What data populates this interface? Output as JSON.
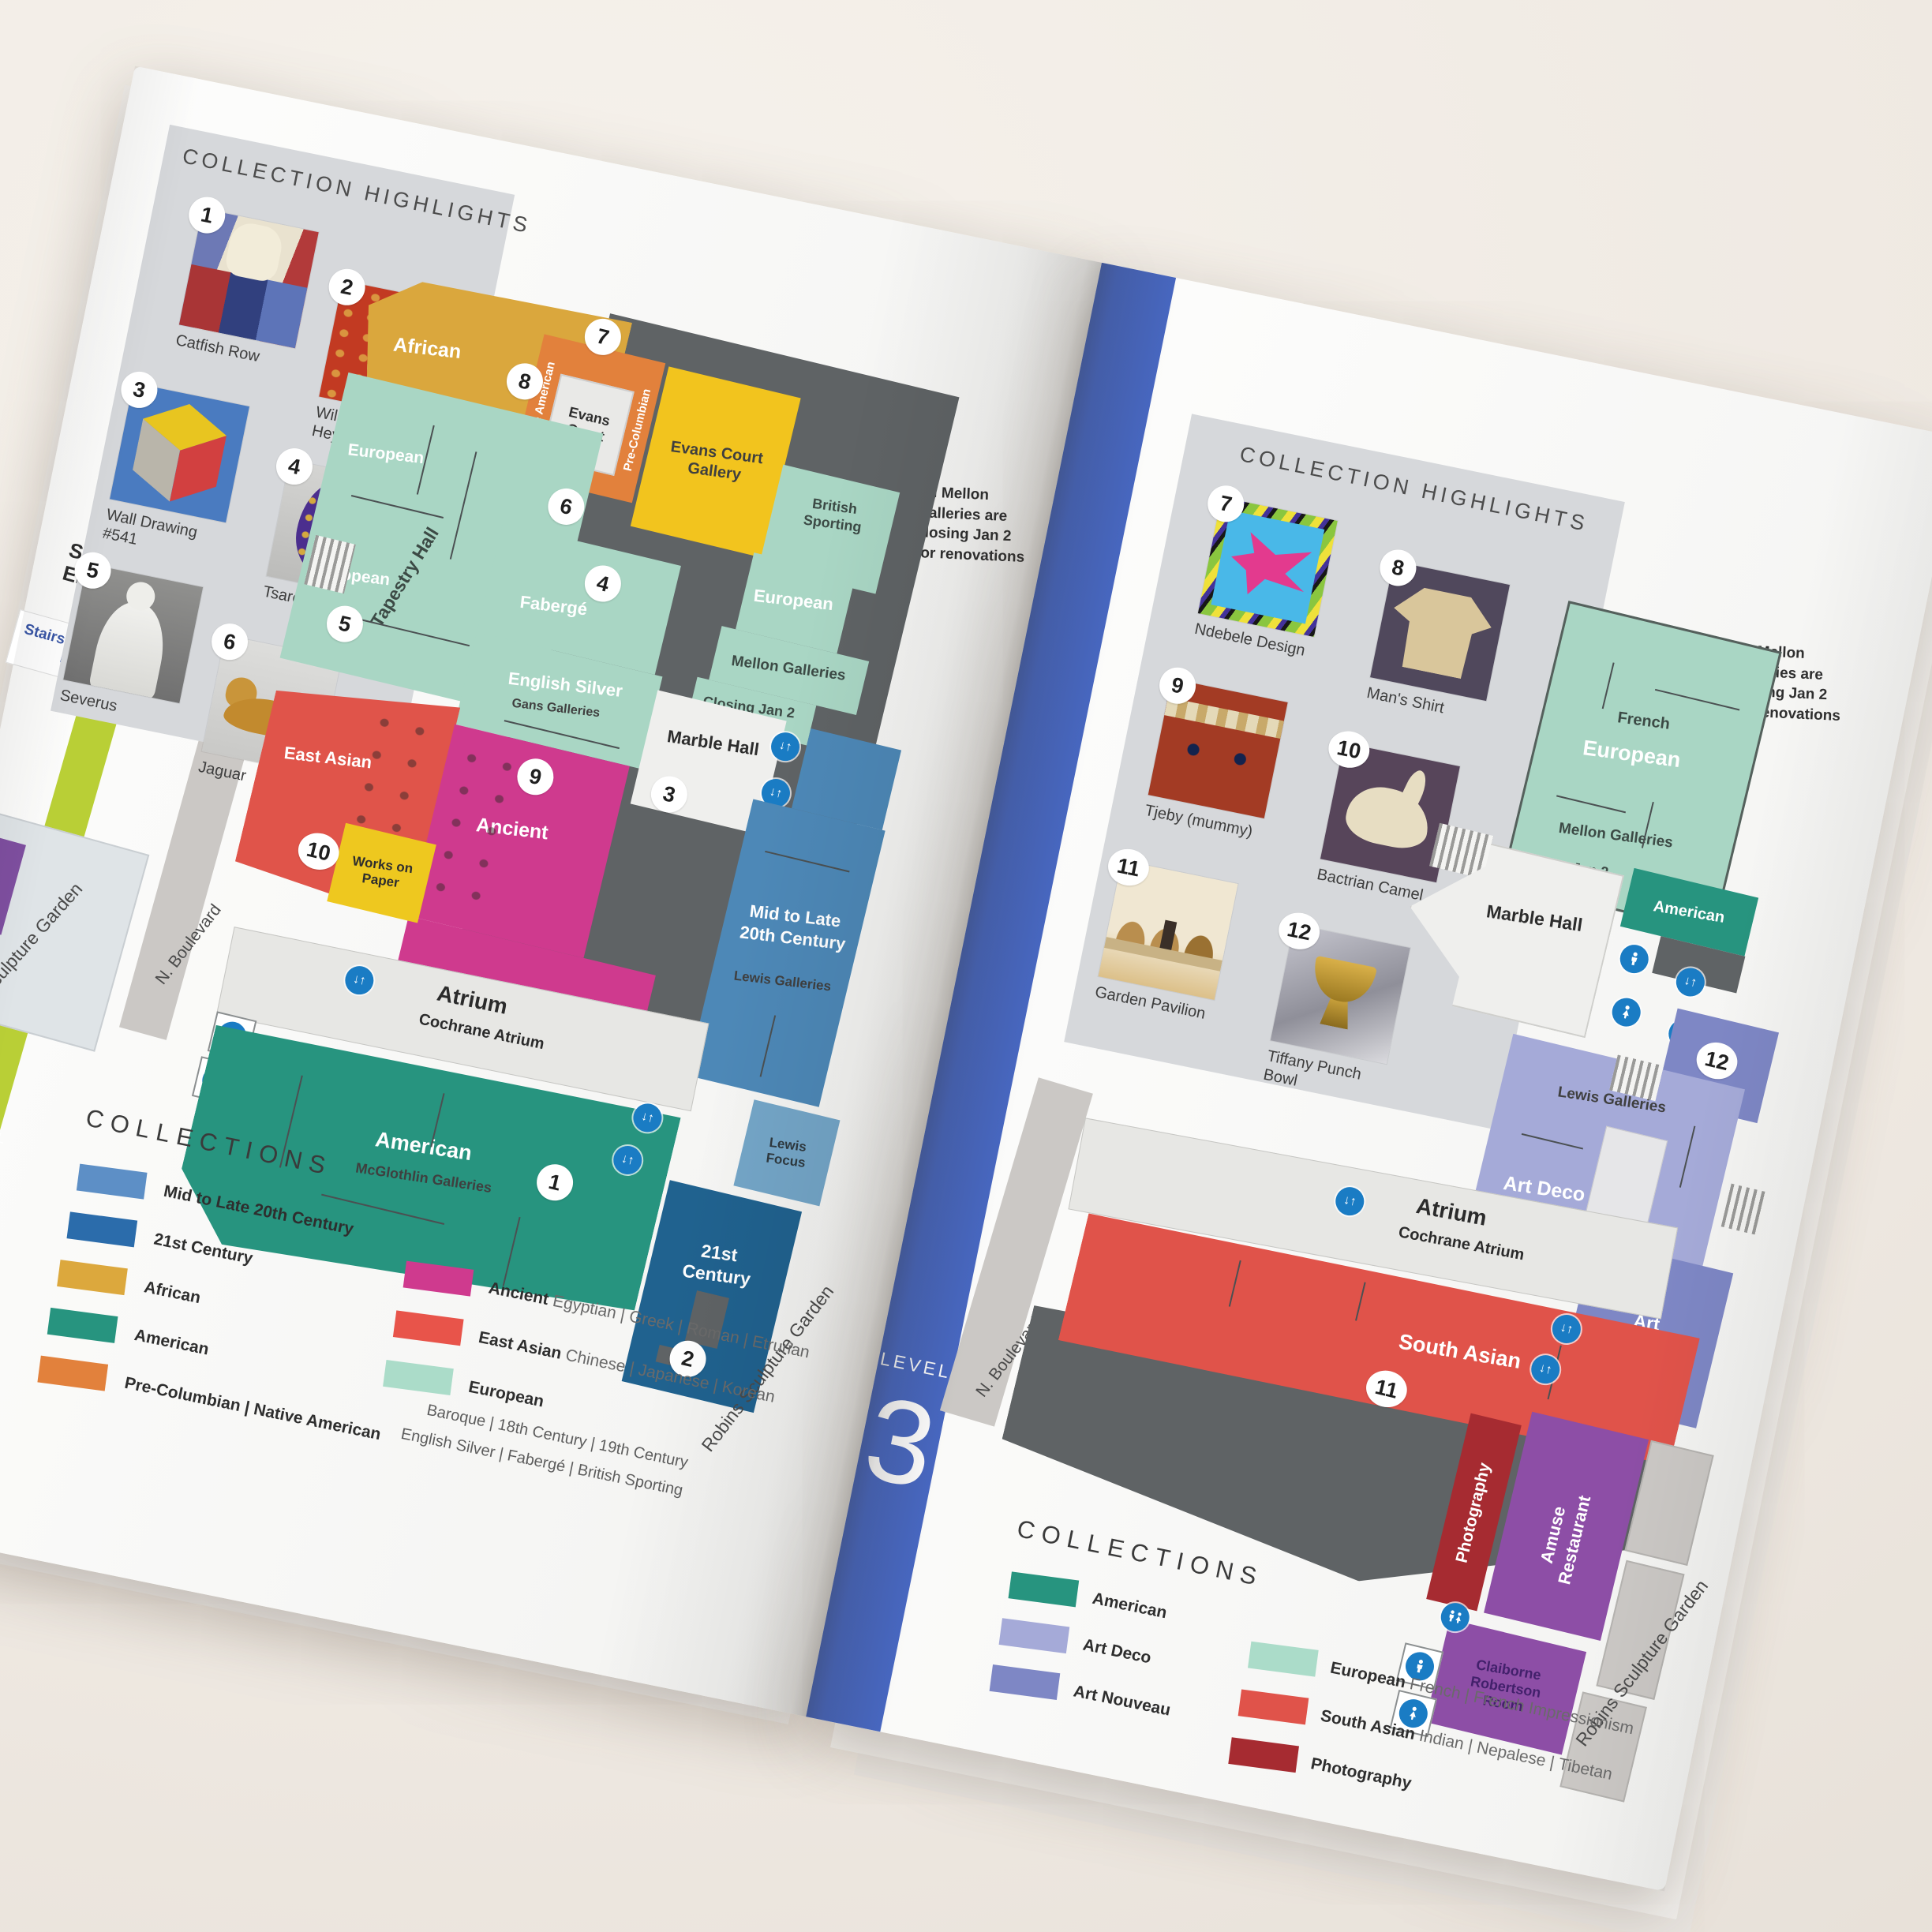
{
  "palette": {
    "limeband": "#b9cf36",
    "blueband": "#4767c1",
    "panel": "#d6d8db",
    "gray": "#5f6365",
    "light": "#e7e7e4",
    "road": "#cbc8c5",
    "mint": "#a9d6c4",
    "ochre": "#daa73d",
    "orange": "#e2813c",
    "yellow": "#f2c41e",
    "red": "#e0544a",
    "magenta": "#cf3a8e",
    "worksyellow": "#eec81f",
    "midblue": "#4d88b7",
    "ltblue": "#74a6c8",
    "darkblue": "#20628f",
    "green": "#27947f",
    "artdeco": "#a5aad8",
    "artnouveau": "#7e87c5",
    "photored": "#a62b31",
    "purple": "#8d4ea6",
    "southred": "#e0534a",
    "marble": "#efefed",
    "plaza": "#dfe4e7",
    "purplechip": "#7f4fa0"
  },
  "left_page": {
    "level_band": {
      "label": "LEVEL",
      "number": "2"
    },
    "margin": {
      "entrance_title": "Sculpture Garden Entrance",
      "stairs_note": "Stairs to Level LL",
      "garden_label": "Robins Sculpture Garden",
      "road_label": "N. Boulevard"
    },
    "highlights": {
      "title": "COLLECTION HIGHLIGHTS",
      "items": [
        {
          "n": "1",
          "caption": "Catfish Row"
        },
        {
          "n": "2",
          "caption": "Willem van Heythuysen"
        },
        {
          "n": "3",
          "caption": "Wall Drawing #541"
        },
        {
          "n": "4",
          "caption": "Tsarevich Egg"
        },
        {
          "n": "5",
          "caption": "Severus"
        },
        {
          "n": "6",
          "caption": "Jaguar"
        }
      ]
    },
    "note": {
      "lines": [
        "All Mellon",
        "Galleries are",
        "closing Jan 2",
        "for renovations"
      ]
    },
    "plan": {
      "african": "African",
      "native_american": "Native American",
      "pre_columbian": "Pre-Columbian",
      "evans_court": "Evans Court",
      "evans_court_gallery": "Evans Court Gallery",
      "british_sporting": "British Sporting",
      "european": "European",
      "mellon_galleries": "Mellon Galleries",
      "closing": "Closing Jan 2",
      "tapestry_hall": "Tapestry Hall",
      "faberge": "Fabergé",
      "english_silver": "English Silver",
      "gans_galleries": "Gans Galleries",
      "marble_hall": "Marble Hall",
      "east_asian": "East Asian",
      "ancient": "Ancient",
      "works_on_paper": "Works on Paper",
      "mid_late": "Mid to Late 20th Century",
      "lewis_galleries": "Lewis Galleries",
      "lewis_focus": "Lewis Focus",
      "atrium": "Atrium",
      "cochrane": "Cochrane Atrium",
      "american": "American",
      "mcglothlin": "McGlothlin Galleries",
      "c21": "21st Century",
      "garden_label": "Robins Sculpture Garden",
      "markers": {
        "m1": "1",
        "m2": "2",
        "m3": "3",
        "m4": "4",
        "m5": "5",
        "m6": "6",
        "m7": "7",
        "m8": "8",
        "m9": "9",
        "m10": "10"
      }
    },
    "legend": {
      "title": "COLLECTIONS",
      "col1": [
        {
          "label": "Mid to Late 20th Century",
          "color": "#5d8fc6"
        },
        {
          "label": "21st Century",
          "color": "#2b6cab"
        },
        {
          "label": "African",
          "color": "#dca83d"
        },
        {
          "label": "American",
          "color": "#27947f"
        },
        {
          "label": "Pre-Columbian | Native American",
          "color": "#e2813c"
        }
      ],
      "col2": [
        {
          "head": "Ancient",
          "rest": " Egyptian | Greek | Roman | Etrurian",
          "color": "#cf3a8e"
        },
        {
          "head": "East Asian",
          "rest": " Chinese | Japanese | Korean",
          "color": "#e8544a"
        },
        {
          "head": "European",
          "rest": " Byzantine | Medieval | Renaissance",
          "color": "#abdcc9"
        }
      ],
      "col2_extra": [
        "Baroque | 18th Century | 19th Century",
        "English Silver | Fabergé | British Sporting"
      ]
    }
  },
  "right_page": {
    "level_band": {
      "label": "LEVEL",
      "number": "3"
    },
    "margin": {
      "garden_label": "Robins Sculpture Garden",
      "road_label": "N. Boulevard"
    },
    "highlights": {
      "title": "COLLECTION HIGHLIGHTS",
      "items": [
        {
          "n": "7",
          "caption": "Ndebele Design"
        },
        {
          "n": "8",
          "caption": "Man's Shirt"
        },
        {
          "n": "9",
          "caption": "Tjeby (mummy)"
        },
        {
          "n": "10",
          "caption": "Bactrian Camel"
        },
        {
          "n": "11",
          "caption": "Garden Pavilion"
        },
        {
          "n": "12",
          "caption": "Tiffany Punch Bowl"
        }
      ]
    },
    "note": {
      "lines": [
        "All Mellon",
        "Galleries are",
        "closing Jan 2",
        "for renovations"
      ]
    },
    "plan": {
      "french": "French",
      "european": "European",
      "mellon_galleries": "Mellon Galleries",
      "closing": "Closing Jan 2",
      "american": "American",
      "marble_hall": "Marble Hall",
      "lewis_galleries": "Lewis Galleries",
      "art_deco": "Art Deco",
      "art_nouveau": "Art Nouveau",
      "atrium": "Atrium",
      "cochrane": "Cochrane Atrium",
      "south_asian": "South Asian",
      "photography": "Photography",
      "amuse_1": "Amuse",
      "amuse_2": "Restaurant",
      "claiborne_1": "Claiborne",
      "claiborne_2": "Robertson",
      "claiborne_3": "Room",
      "markers": {
        "m11": "11",
        "m12": "12"
      }
    },
    "legend": {
      "title": "COLLECTIONS",
      "col1": [
        {
          "label": "American",
          "color": "#27947f"
        },
        {
          "label": "Art Deco",
          "color": "#a5aad8"
        },
        {
          "label": "Art Nouveau",
          "color": "#7e87c5"
        }
      ],
      "col2": [
        {
          "head": "European",
          "rest": " French | French Impressionism",
          "color": "#abdcc9"
        },
        {
          "head": "South Asian",
          "rest": " Indian | Nepalese | Tibetan",
          "color": "#e0534a"
        },
        {
          "head": "Photography",
          "rest": "",
          "color": "#a62b31"
        }
      ]
    }
  }
}
